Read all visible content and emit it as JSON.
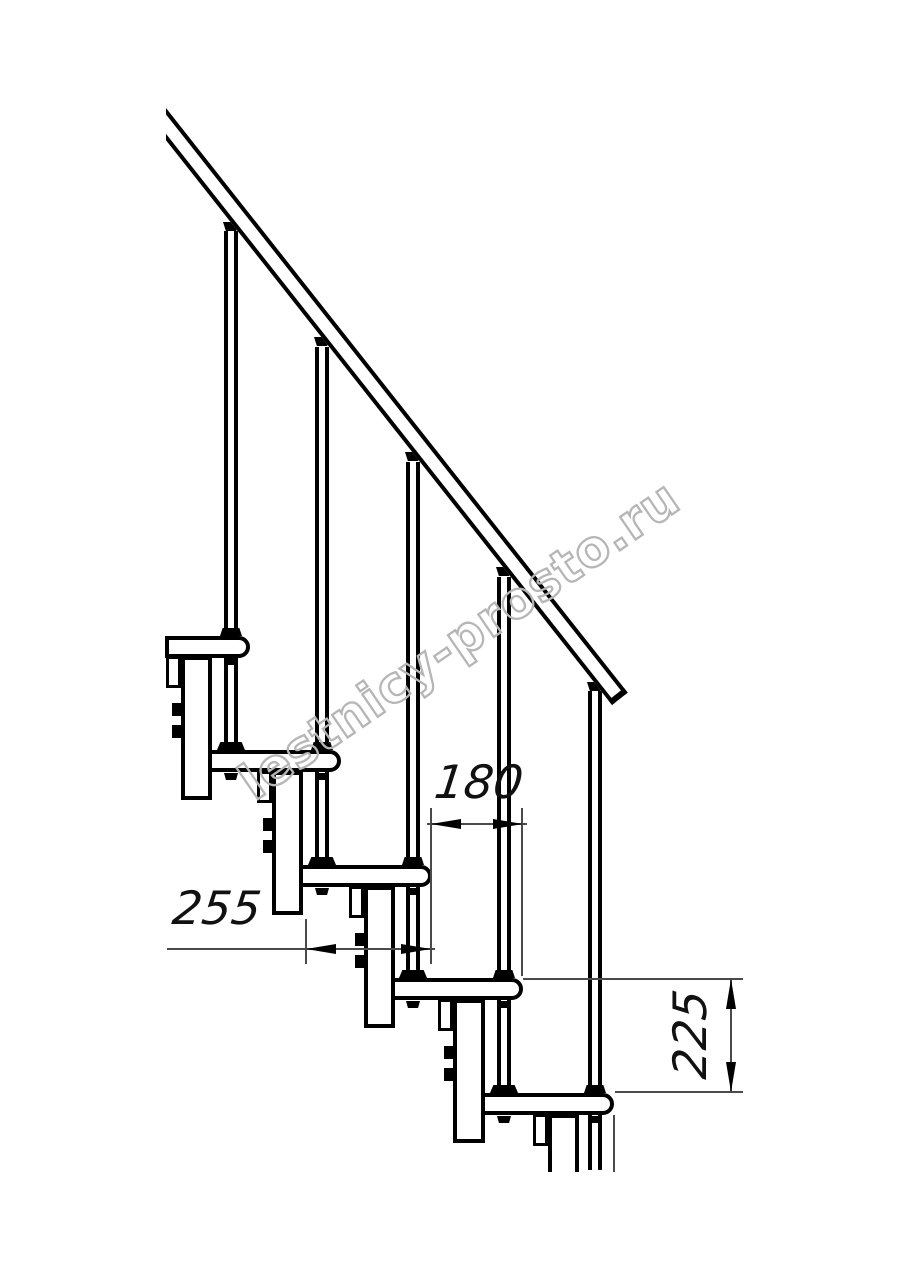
{
  "page": {
    "background": "#ffffff",
    "ink_color": "#000000",
    "dim_line_color": "#4a4a4a"
  },
  "drawing": {
    "dims": [
      {
        "id": "dim-180",
        "label": "180",
        "orientation": "horizontal"
      },
      {
        "id": "dim-255",
        "label": "255",
        "orientation": "horizontal"
      },
      {
        "id": "dim-225",
        "label": "225",
        "orientation": "vertical"
      }
    ],
    "watermark": {
      "text": "lestnicy-prosto.ru",
      "stroke_color": "#b6b6b6"
    },
    "parts": {
      "treads": 5,
      "balusters": 5,
      "support_modules": 5,
      "handrails": 1
    }
  }
}
